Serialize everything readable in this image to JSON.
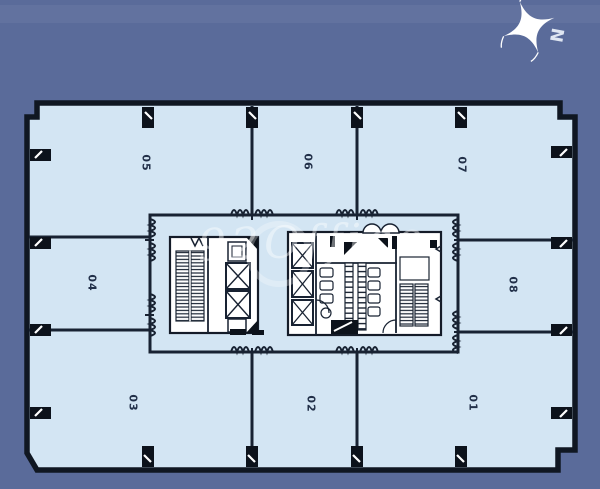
{
  "compass": {
    "north_label": "N"
  },
  "watermark": {
    "text": "92Office"
  },
  "floor_plan": {
    "units": [
      {
        "label": "05"
      },
      {
        "label": "06"
      },
      {
        "label": "07"
      },
      {
        "label": "04"
      },
      {
        "label": "08"
      },
      {
        "label": "03"
      },
      {
        "label": "02"
      },
      {
        "label": "01"
      }
    ],
    "core_features": [
      "stairs-icon",
      "elevator-icon",
      "toilet-icon",
      "door-swing-icon"
    ]
  },
  "colors": {
    "background": "#5a6b9a",
    "plan_fill": "#d3e5f3",
    "outer_wall": "#101722",
    "partition_wall": "#182232",
    "unit_label": "#223049",
    "watermark": "#ffffff",
    "compass": "#ffffff"
  }
}
